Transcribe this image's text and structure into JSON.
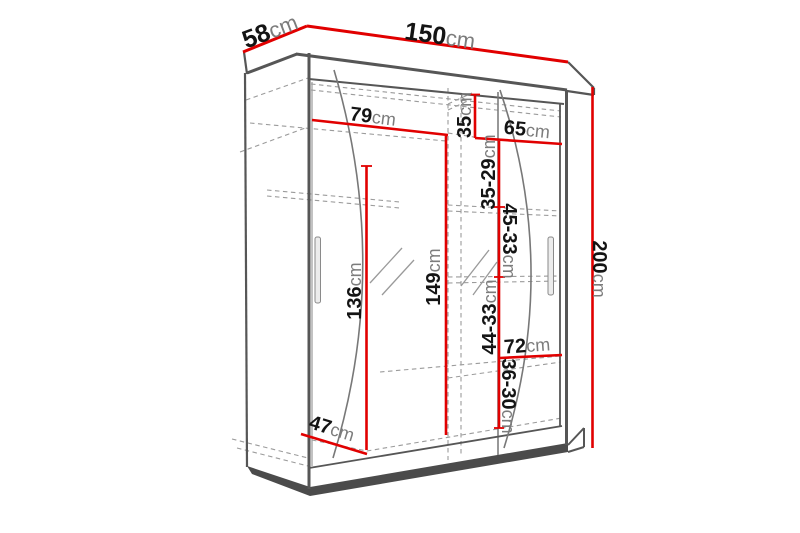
{
  "diagram": {
    "title": "wardrobe-dimension-drawing",
    "unit": "cm",
    "colors": {
      "dimension_red": "#e10000",
      "outline_gray": "#565656",
      "hidden_dashed_gray": "#9b9b9b",
      "plinth_dark": "#4b4b4b",
      "number_black": "#141414",
      "unit_gray": "#7c7c7c",
      "background": "#ffffff"
    },
    "dims": {
      "w150": {
        "num": "150",
        "unit": "cm"
      },
      "d58": {
        "num": "58",
        "unit": "cm"
      },
      "h200": {
        "num": "200",
        "unit": "cm"
      },
      "w79": {
        "num": "79",
        "unit": "cm"
      },
      "w65": {
        "num": "65",
        "unit": "cm"
      },
      "h35": {
        "num": "35",
        "unit": "cm"
      },
      "h3529": {
        "num": "35-29",
        "unit": "cm"
      },
      "h4533": {
        "num": "45-33",
        "unit": "cm"
      },
      "h4433": {
        "num": "44-33",
        "unit": "cm"
      },
      "w72": {
        "num": "72",
        "unit": "cm"
      },
      "h3630": {
        "num": "36-30",
        "unit": "cm"
      },
      "h136": {
        "num": "136",
        "unit": "cm"
      },
      "h149": {
        "num": "149",
        "unit": "cm"
      },
      "w47": {
        "num": "47",
        "unit": "cm"
      }
    }
  }
}
